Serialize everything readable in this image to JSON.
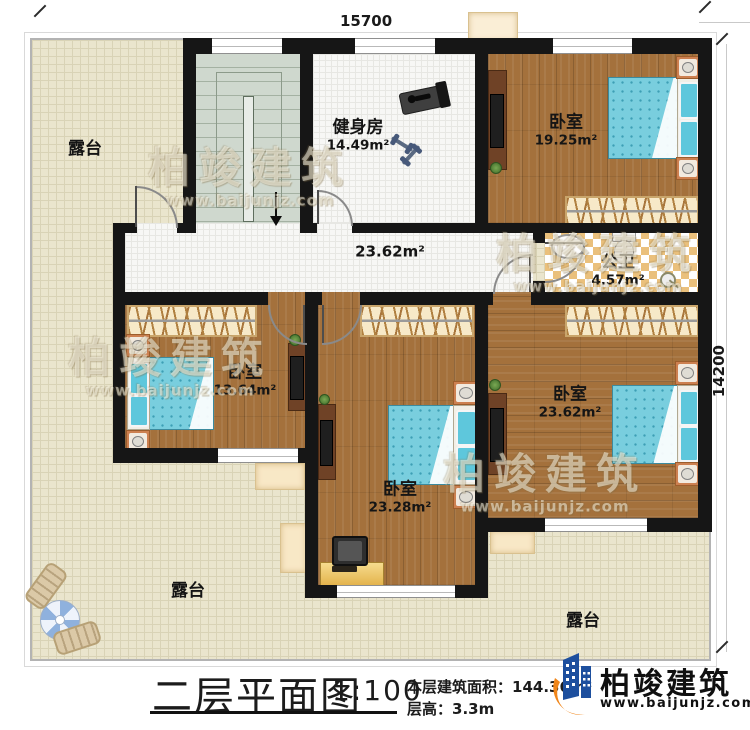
{
  "dimensions": {
    "top": "15700",
    "right": "14200"
  },
  "rooms": {
    "gym": {
      "name": "健身房",
      "area": "14.49m²"
    },
    "bedroom_top": {
      "name": "卧室",
      "area": "19.25m²"
    },
    "bathroom": {
      "name": "公卫",
      "area": "4.57m²"
    },
    "hallway": {
      "area": "23.62m²"
    },
    "bedroom_left": {
      "name": "卧室",
      "area": "13.64m²"
    },
    "bedroom_middle": {
      "name": "卧室",
      "area": "23.28m²"
    },
    "bedroom_right": {
      "name": "卧室",
      "area": "23.62m²"
    },
    "terrace_top_left": {
      "name": "露台"
    },
    "terrace_bottom_left": {
      "name": "露台"
    },
    "terrace_bottom_right": {
      "name": "露台"
    }
  },
  "titleblock": {
    "title": "二层平面图",
    "scale": "1:100",
    "area_label": "本层建筑面积：",
    "area_value": "144.36m²",
    "height_label": "层高：",
    "height_value": "3.3m"
  },
  "brand": {
    "name": "柏竣建筑",
    "website": "www.baijunjz.com"
  },
  "watermark": {
    "name": "柏竣建筑",
    "website": "www.baijunjz.com"
  },
  "colors": {
    "brand_blue": "#1d4f9e",
    "brand_orange": "#f08519",
    "wood": "#a4713c",
    "bed": "#79cede",
    "terrace": "#eae5cd"
  }
}
